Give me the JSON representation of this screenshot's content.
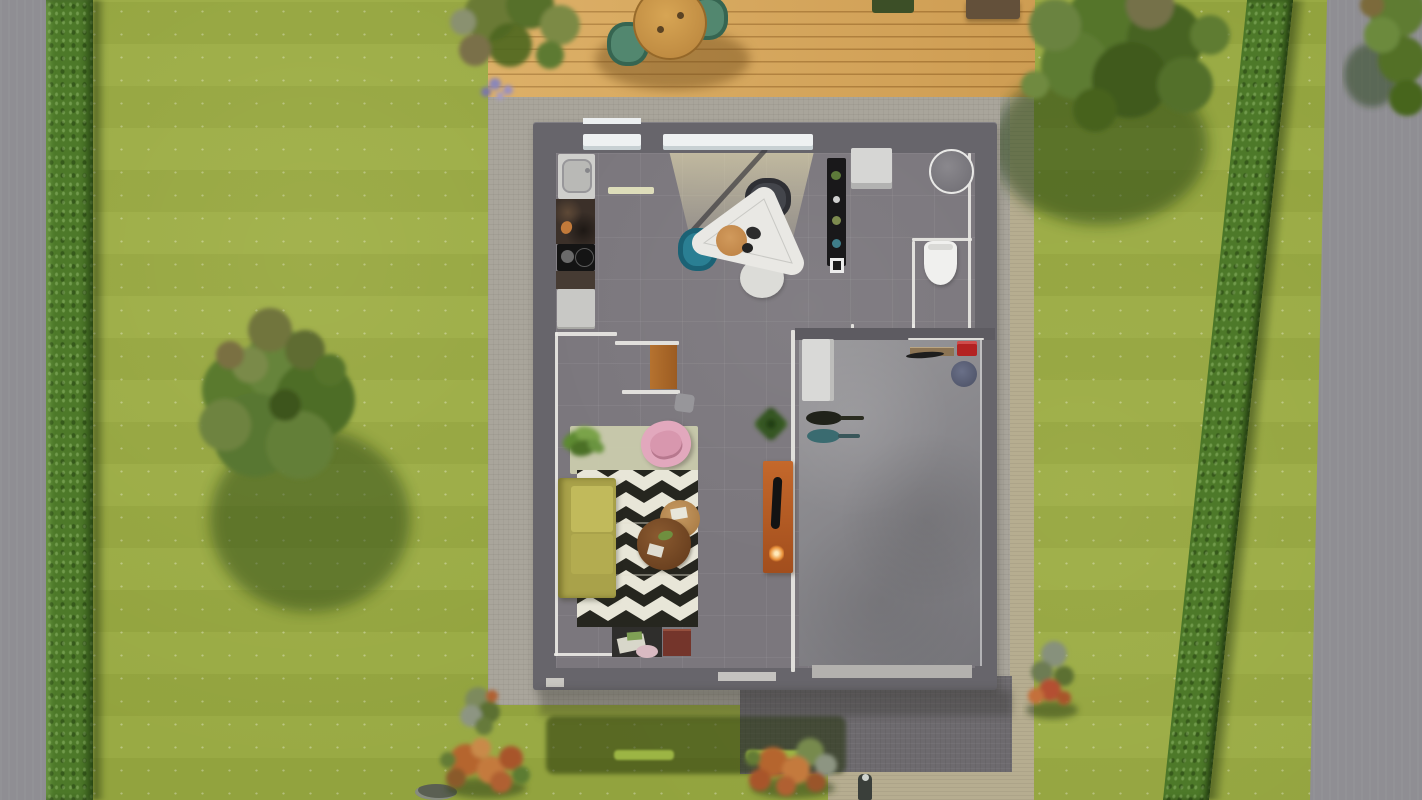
{
  "scene": {
    "type": "3d-architectural-render",
    "view": "top-down bird's eye",
    "description": "Top-down 3D render of a small single-storey house on a lawn plot with hedges, trees, wooden deck terrace, stone patio and driveway"
  },
  "colors": {
    "lawn": "#97a840",
    "road": "#8f8e93",
    "hedge": "#4d7929",
    "deck-wood": "#d8a75a",
    "deck-plank-line": "#b07f3a",
    "deck-table": "#c6913f",
    "deck-chair": "#52876f",
    "pavement": "#a9a59b",
    "path": "#b6ad90",
    "driveway": "#6d6a6e",
    "wall": "#67656b",
    "wall-inner": "#e9e8e4",
    "floor": "#7b777d",
    "garage-floor": "#8a898d",
    "kitchen-counter": "#3b3029",
    "cabinet": "#c8c8c5",
    "dining-table": "#e9e8e4",
    "chair-teal": "#2a7f93",
    "chair-dark": "#43454b",
    "sofa-olive": "#a9a24a",
    "sofa-cushion": "#c1ba5b",
    "rug-dark": "#26261f",
    "rug-light": "#e8e6d8",
    "rug-pale": "#ccceae",
    "armchair-pink": "#e2a8bd",
    "desk-wood": "#b5722f",
    "tv-board-orange": "#c4682b",
    "coffee-table-dark": "#7c4e27",
    "coffee-table-light": "#b98a55",
    "cabinet-red": "#74352b",
    "toolbox-red": "#b32222",
    "bucket-blue": "#5a5f74",
    "tool-teal": "#3a6b70",
    "plant-green": "#4f7a2e",
    "bush-orange": "#bf6f38",
    "tree-green": "#5a7a2e"
  },
  "garden": {
    "surfaces": [
      "lawn",
      "left-sidewalk",
      "left-hedge",
      "right-hedge",
      "right-road",
      "wooden-deck",
      "stone-patio",
      "driveway",
      "sand-path",
      "dark-grass-strip"
    ],
    "trees": [
      "left-lawn-tree",
      "northeast-tree",
      "corner-tree",
      "deck-corner-foliage"
    ],
    "bushes": [
      "green-bush-by-path",
      "orange-bush-left",
      "orange-bush-center",
      "red-bush-east"
    ],
    "deck_furniture": [
      "round-wood-table",
      "teal-garden-chair-left",
      "teal-garden-chair-right",
      "planter-green",
      "planter-brown"
    ]
  },
  "house": {
    "label": "single-storey house, roof removed section view",
    "rooms": [
      {
        "name": "kitchen-dining",
        "furniture": [
          "kitchen-sink",
          "dark-counter",
          "cooktop",
          "low-counter",
          "white-cabinet",
          "triangular-dining-table",
          "serving-plate",
          "teal-dining-chair",
          "dark-dining-chair",
          "white-dining-chair",
          "window-sill-small",
          "window-sill-large"
        ]
      },
      {
        "name": "bathroom-laundry",
        "furniture": [
          "tall-black-shelf",
          "washing-machine",
          "round-washbasin",
          "toilet"
        ]
      },
      {
        "name": "living-room",
        "furniture": [
          "wood-desk",
          "desk-chair",
          "pale-rug",
          "zigzag-rug",
          "pink-armchair",
          "potted-plant",
          "olive-sofa",
          "large-round-coffee-table",
          "small-round-coffee-table",
          "black-sideboard",
          "red-brown-cabinet"
        ]
      },
      {
        "name": "hallway",
        "furniture": [
          "potted-plant",
          "orange-tv-sideboard",
          "tv",
          "glowing-lamp"
        ]
      },
      {
        "name": "garage",
        "furniture": [
          "white-freezer-box",
          "black-garden-tool",
          "teal-garden-tool",
          "wall-shelf",
          "red-toolbox",
          "blue-bucket"
        ]
      }
    ]
  }
}
